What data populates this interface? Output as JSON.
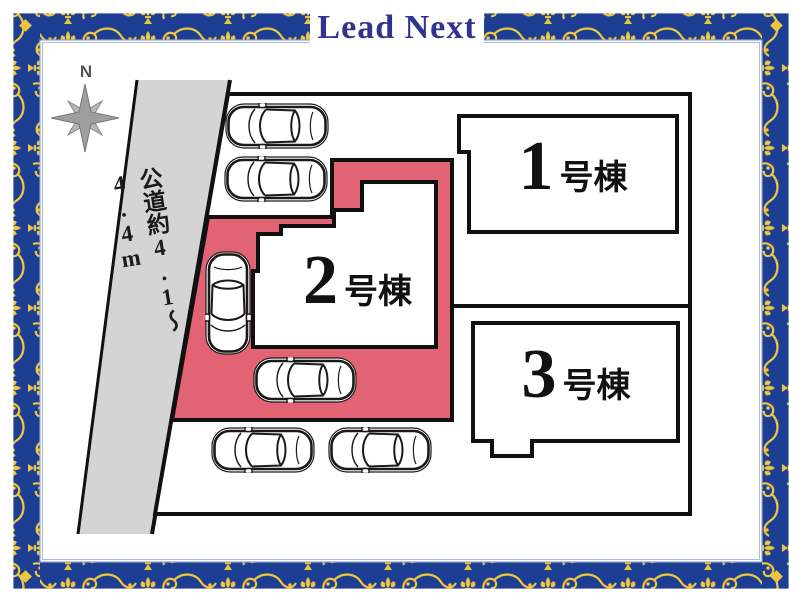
{
  "brand": {
    "logo_text": "Lead Next"
  },
  "compass": {
    "north_label": "N"
  },
  "road": {
    "label": "公道約4.1〜4.4m"
  },
  "buildings": [
    {
      "number": "1",
      "suffix": "号棟",
      "highlighted": false
    },
    {
      "number": "2",
      "suffix": "号棟",
      "highlighted": true
    },
    {
      "number": "3",
      "suffix": "号棟",
      "highlighted": false
    }
  ],
  "parking": {
    "car_count": 6
  },
  "colors": {
    "highlight_pink": "#e26373",
    "road_gray": "#d4d4d4",
    "frame_blue": "#1c3f94",
    "ornament_gold": "#eec63e",
    "logo_blue": "#32338e",
    "outline_black": "#111111"
  }
}
